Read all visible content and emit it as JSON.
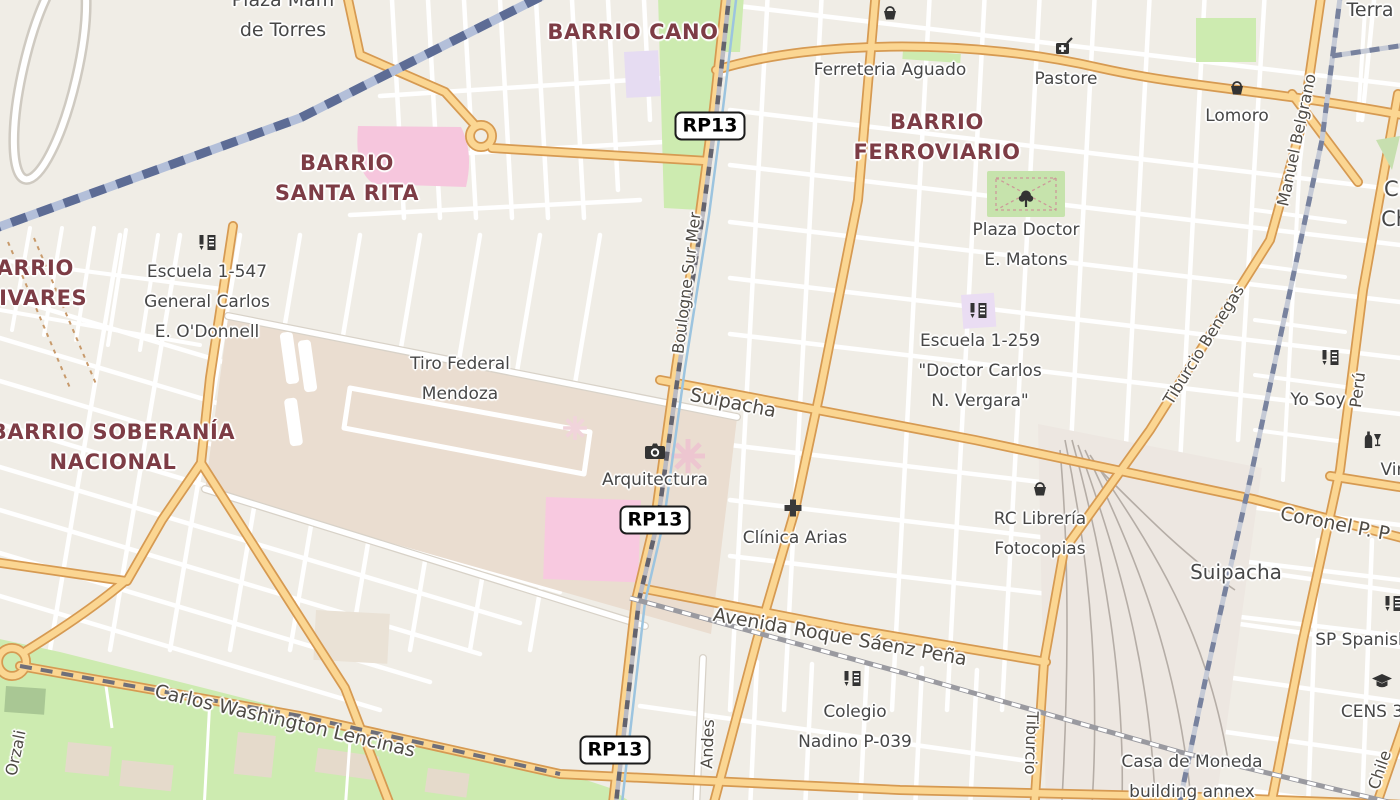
{
  "map": {
    "kind": "openstreetmap-style rendered city map",
    "interaction_hint": "pannable map canvas"
  },
  "colors": {
    "land": "#F0EDE6",
    "road_fill": "#FBD692",
    "road_casing": "#D69A52",
    "minor_road": "#FFFFFF",
    "park_green": "#CDEBB0",
    "tan_area": "#EADDD0",
    "pink_area": "#F6C6DD",
    "school_purple": "#E6DCF2",
    "railway_blue": "#5D6C95",
    "railway_gray": "#8A8A94",
    "water_blue": "#9CC4DF",
    "neighborhood_text": "#7D3C45",
    "poi_text": "#474747",
    "street_text": "#4F4B45"
  },
  "route_badges": [
    {
      "name": "route-badge-rp13-north",
      "label": "RP13",
      "x": 710,
      "y": 126
    },
    {
      "name": "route-badge-rp13-mid",
      "label": "RP13",
      "x": 655,
      "y": 520
    },
    {
      "name": "route-badge-rp13-south",
      "label": "RP13",
      "x": 615,
      "y": 750
    }
  ],
  "neighborhoods": [
    {
      "name": "neighborhood-label-barrio-cano",
      "lines": [
        "BARRIO CANO"
      ],
      "x": 633,
      "y": 32
    },
    {
      "name": "neighborhood-label-barrio-ferroviario",
      "lines": [
        "BARRIO",
        "FERROVIARIO"
      ],
      "x": 937,
      "y": 137
    },
    {
      "name": "neighborhood-label-barrio-santa-rita",
      "lines": [
        "BARRIO",
        "SANTA RITA"
      ],
      "x": 347,
      "y": 178
    },
    {
      "name": "neighborhood-label-barrio-olivares",
      "lines": [
        "BARRIO",
        "OLIVARES"
      ],
      "x": 27,
      "y": 283
    },
    {
      "name": "neighborhood-label-barrio-soberania-nacional",
      "lines": [
        "BARRIO SOBERANÍA",
        "NACIONAL"
      ],
      "x": 113,
      "y": 447
    }
  ],
  "pois": [
    {
      "name": "poi-label-plaza-de-torres",
      "lines": [
        "Plaza Mam",
        "de Torres"
      ],
      "x": 283,
      "y": 15,
      "size": 19
    },
    {
      "name": "poi-label-ferreteria-aguado",
      "lines": [
        "Ferreteria Aguado"
      ],
      "x": 890,
      "y": 70
    },
    {
      "name": "poi-label-pastore",
      "lines": [
        "Pastore"
      ],
      "x": 1066,
      "y": 79
    },
    {
      "name": "poi-label-lomoro",
      "lines": [
        "Lomoro"
      ],
      "x": 1237,
      "y": 116
    },
    {
      "name": "poi-label-plaza-doctor-e-matons",
      "lines": [
        "Plaza Doctor",
        "E. Matons"
      ],
      "x": 1026,
      "y": 245
    },
    {
      "name": "poi-label-escuela-1-259",
      "lines": [
        "Escuela 1-259",
        "\"Doctor Carlos",
        "N. Vergara\""
      ],
      "x": 980,
      "y": 371
    },
    {
      "name": "poi-label-escuela-1-547",
      "lines": [
        "Escuela 1-547",
        "General Carlos",
        "E. O'Donnell"
      ],
      "x": 207,
      "y": 302
    },
    {
      "name": "poi-label-tiro-federal-mendoza",
      "lines": [
        "Tiro Federal",
        "Mendoza"
      ],
      "x": 460,
      "y": 379
    },
    {
      "name": "poi-label-arquitectura",
      "lines": [
        "Arquitectura"
      ],
      "x": 655,
      "y": 480
    },
    {
      "name": "poi-label-clinica-arias",
      "lines": [
        "Clínica Arias"
      ],
      "x": 795,
      "y": 538
    },
    {
      "name": "poi-label-rc-libreria-fotocopias",
      "lines": [
        "RC Librería",
        "Fotocopias"
      ],
      "x": 1040,
      "y": 534
    },
    {
      "name": "poi-label-yo-soy",
      "lines": [
        "Yo Soy"
      ],
      "x": 1318,
      "y": 400
    },
    {
      "name": "poi-label-vineria",
      "lines": [
        "Vineri"
      ],
      "x": 1405,
      "y": 470
    },
    {
      "name": "poi-label-sp-spanish",
      "lines": [
        "SP Spanish"
      ],
      "x": 1362,
      "y": 640
    },
    {
      "name": "poi-label-cens-3",
      "lines": [
        "CENS 3"
      ],
      "x": 1372,
      "y": 712
    },
    {
      "name": "poi-label-colegio-nadino",
      "lines": [
        "Colegio",
        "Nadino P-039"
      ],
      "x": 855,
      "y": 727
    },
    {
      "name": "poi-label-casa-de-moneda",
      "lines": [
        "Casa de Moneda",
        "building annex"
      ],
      "x": 1192,
      "y": 777
    },
    {
      "name": "poi-label-suipacha-area",
      "lines": [
        "Suipacha"
      ],
      "x": 1236,
      "y": 572,
      "size": 20
    },
    {
      "name": "poi-label-ce-chi",
      "lines": [
        "CE",
        "Chi"
      ],
      "x": 1398,
      "y": 204,
      "size": 21
    },
    {
      "name": "poi-label-terra",
      "lines": [
        "Terra"
      ],
      "x": 1370,
      "y": 10,
      "size": 19
    }
  ],
  "streets": [
    {
      "name": "street-label-boulogne-sur-mer",
      "text": "Boulogne Sur Mer",
      "x": 687,
      "y": 283,
      "rot": -83
    },
    {
      "name": "street-label-suipacha",
      "text": "Suipacha",
      "x": 733,
      "y": 403,
      "rot": 11,
      "size": 19
    },
    {
      "name": "street-label-coronel-p",
      "text": "Coronel P. P",
      "x": 1335,
      "y": 524,
      "rot": 11,
      "size": 19
    },
    {
      "name": "street-label-avenida-roque-saenz-pena",
      "text": "Avenida Roque Sáenz Peña",
      "x": 840,
      "y": 637,
      "rot": 10,
      "size": 19
    },
    {
      "name": "street-label-carlos-washington-lencinas",
      "text": "Carlos Washington Lencinas",
      "x": 285,
      "y": 721,
      "rot": 13,
      "size": 19
    },
    {
      "name": "street-label-manuel-belgrano",
      "text": "Manuel Belgrano",
      "x": 1297,
      "y": 140,
      "rot": -78
    },
    {
      "name": "street-label-tiburcio-benegas",
      "text": "Tiburcio Benegas",
      "x": 1204,
      "y": 345,
      "rot": -58
    },
    {
      "name": "street-label-peru",
      "text": "Perú",
      "x": 1358,
      "y": 390,
      "rot": -83
    },
    {
      "name": "street-label-andes",
      "text": "Andes",
      "x": 708,
      "y": 744,
      "rot": -88
    },
    {
      "name": "street-label-tiburcio",
      "text": "Tiburcio",
      "x": 1031,
      "y": 743,
      "rot": 92
    },
    {
      "name": "street-label-orzali",
      "text": "Orzali",
      "x": 16,
      "y": 753,
      "rot": -78
    },
    {
      "name": "street-label-chile",
      "text": "Chile",
      "x": 1380,
      "y": 770,
      "rot": -71
    }
  ],
  "icons": [
    {
      "name": "ferreteria-aguado-shop-icon",
      "glyph": "basket"
    },
    {
      "name": "lomoro-shop-icon",
      "glyph": "basket"
    },
    {
      "name": "rc-libreria-shop-icon",
      "glyph": "basket"
    },
    {
      "name": "pastore-doctors-bag-icon",
      "glyph": "medical-bag"
    },
    {
      "name": "plaza-matons-tree-icon",
      "glyph": "tree"
    },
    {
      "name": "escuela-1-547-school-icon",
      "glyph": "school"
    },
    {
      "name": "escuela-1-259-school-icon",
      "glyph": "school"
    },
    {
      "name": "yo-soy-school-icon",
      "glyph": "school"
    },
    {
      "name": "colegio-nadino-school-icon",
      "glyph": "school"
    },
    {
      "name": "sp-spanish-school-icon",
      "glyph": "school"
    },
    {
      "name": "cens-graduation-cap-icon",
      "glyph": "graduation-cap"
    },
    {
      "name": "vineria-wine-icon",
      "glyph": "wine"
    },
    {
      "name": "clinica-arias-cross-icon",
      "glyph": "medical-cross"
    },
    {
      "name": "arquitectura-camera-icon",
      "glyph": "camera"
    }
  ]
}
